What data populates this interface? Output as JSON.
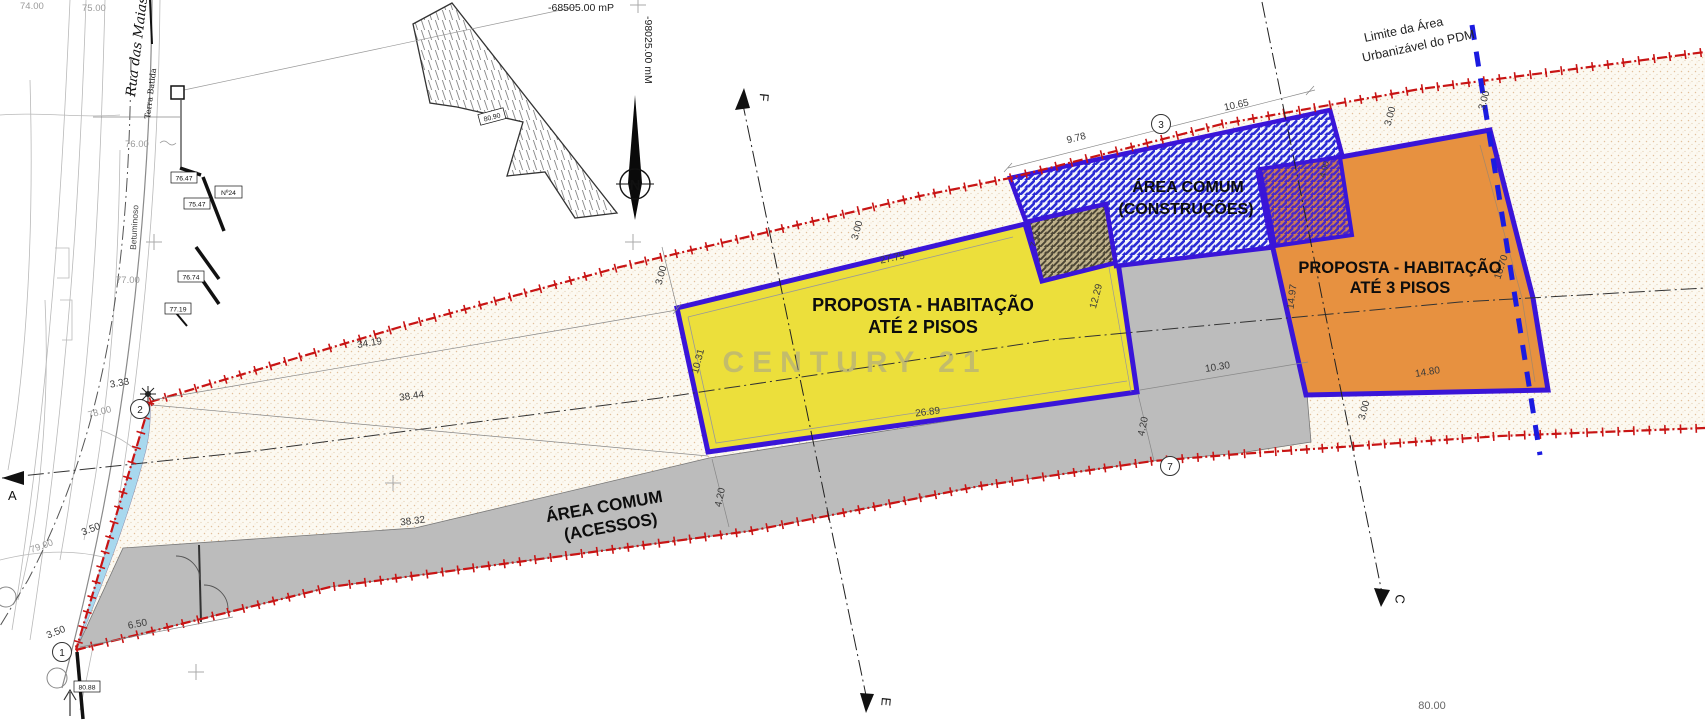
{
  "document": {
    "watermark": "CENTURY 21"
  },
  "zones": {
    "habitacao2": {
      "line1": "PROPOSTA - HABITAÇÃO",
      "line2": "ATÉ 2 PISOS",
      "fill": "#ecdf3b"
    },
    "habitacao3": {
      "line1": "PROPOSTA - HABITAÇÃO",
      "line2": "ATÉ 3 PISOS",
      "fill": "#e79140"
    },
    "construcoes": {
      "line1": "ÁREA COMUM",
      "line2": "(CONSTRUÇÕES)",
      "hatch_color": "#2b2bd5"
    },
    "acessos": {
      "line1": "ÁREA COMUM",
      "line2": "(ACESSOS)",
      "fill": "#bcbcbc"
    },
    "border_color": "#3a15d8",
    "boundary_color": "#c81414",
    "pdm_line_color": "#1b1be0"
  },
  "annotations": {
    "pdm_line1": "Limite da Área",
    "pdm_line2": "Urbanizável do  PDM",
    "coord_mp": "-68505.00 mP",
    "coord_mm": "-98025.00 mM",
    "north": "N",
    "street": "Rua das Maias",
    "terra_batida": "Terra Batida",
    "betuminoso": "Betuminoso"
  },
  "sections": {
    "a": "A",
    "c": "C",
    "e": "E",
    "f": "F"
  },
  "points": {
    "p1": "1",
    "p2": "2",
    "p3": "3",
    "p7": "7"
  },
  "levels": {
    "v7647": "76.47",
    "v7547": "75.47",
    "v7674": "76.74",
    "v7719": "77.19",
    "v8088": "80.88",
    "n24": "Nº24",
    "building": "80.90"
  },
  "contours": {
    "c74": "74.00",
    "c75": "75.00",
    "c76": "76.00",
    "c77": "77.00",
    "c78": "78.00",
    "c79": "79.00",
    "c80": "80.00"
  },
  "dims": {
    "d3419": "34.19",
    "d3844": "38.44",
    "d3832": "38.32",
    "d650": "6.50",
    "d350": "3.50",
    "d333": "3.33",
    "d2775": "27.75",
    "d2689": "26.89",
    "d1031": "10.31",
    "d1229": "12.29",
    "d978": "9.78",
    "d1065": "10.65",
    "d1030": "10.30",
    "d420": "4.20",
    "d1497": "14.97",
    "d1480": "14.80",
    "d1670": "16.70",
    "d300": "3.00",
    "d8000": "80.00",
    "d710": "7.10",
    "d400": "4.00"
  }
}
